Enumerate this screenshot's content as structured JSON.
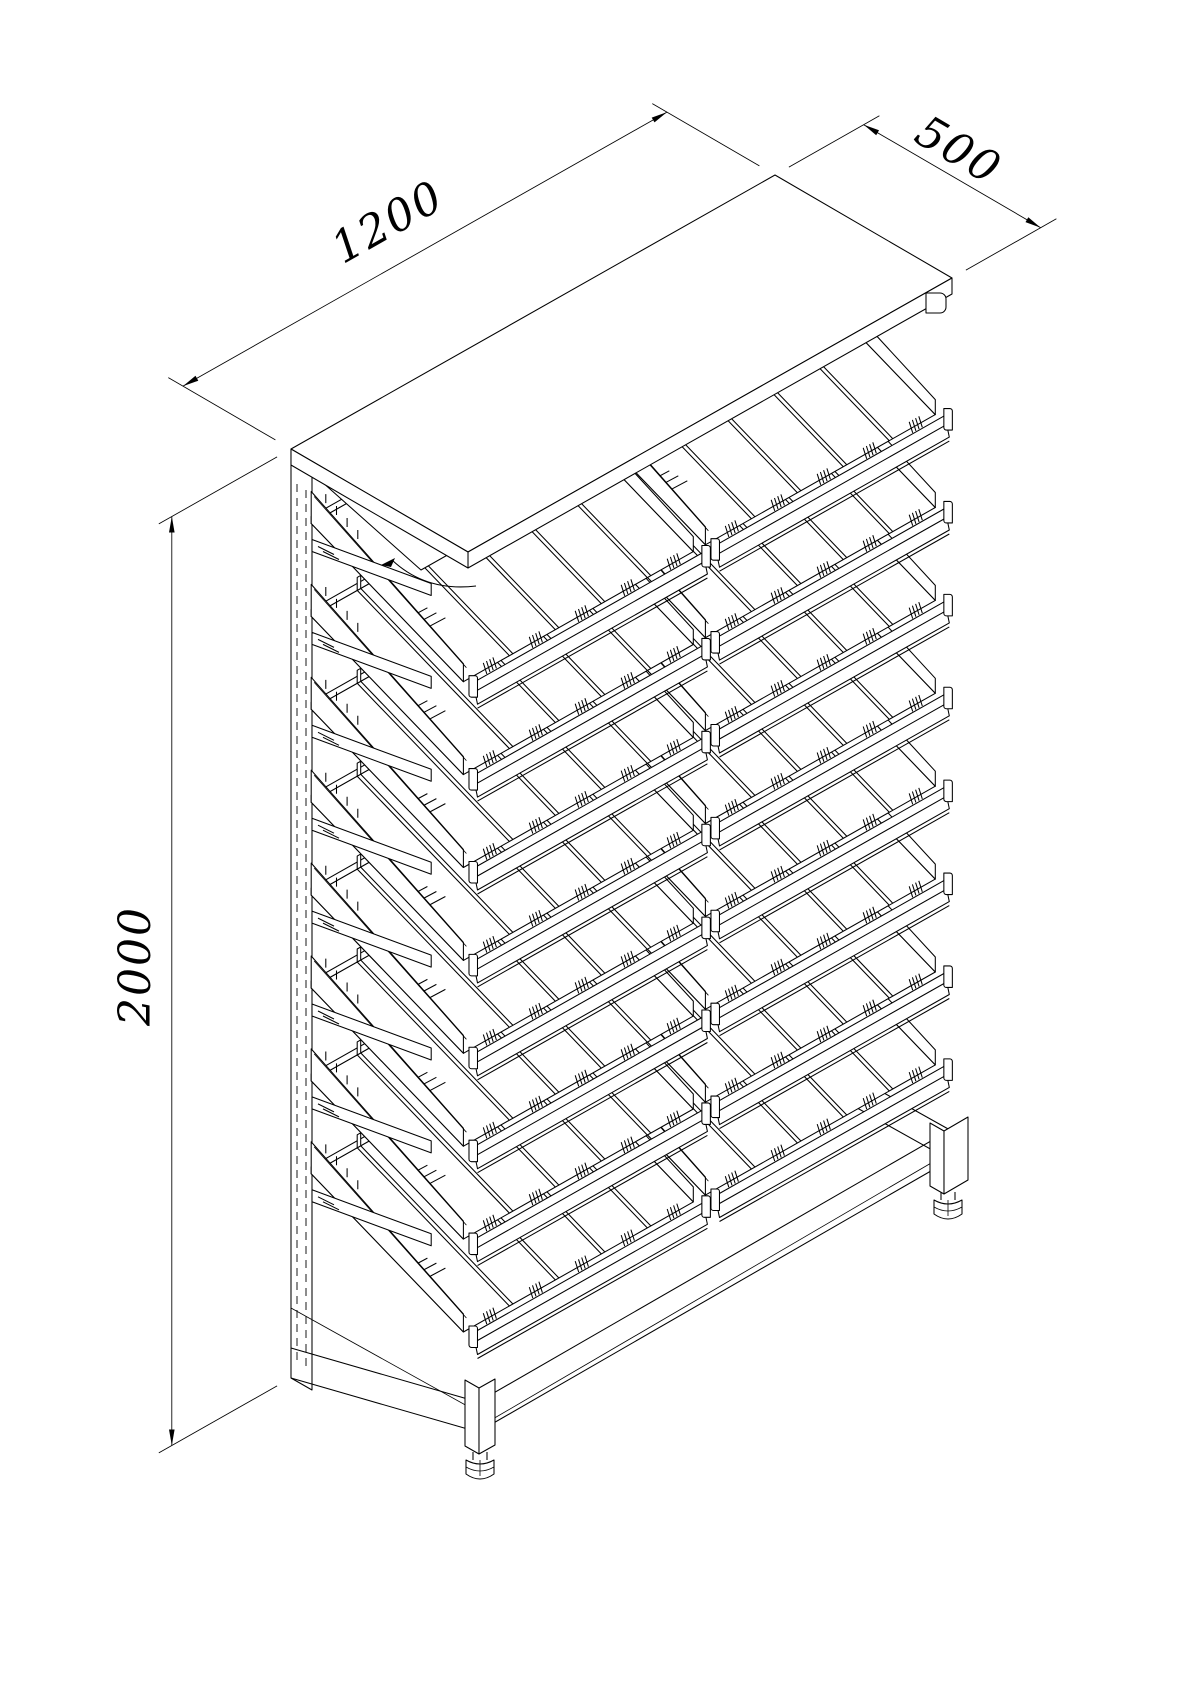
{
  "drawing": {
    "title": "display-rack-isometric-drawing",
    "background_color": "#ffffff",
    "line_color": "#000000",
    "dimensions": {
      "width": {
        "label": "1200"
      },
      "depth": {
        "label": "500"
      },
      "height": {
        "label": "2000"
      }
    },
    "structure": {
      "shelf_rows": 8,
      "bays_per_row": 2,
      "lanes_per_bay": 5,
      "dividers_per_bay": 4,
      "ticks_per_lane": 4,
      "has_canopy": true,
      "back_panel_slotted": true,
      "visible_legs": 2,
      "adjustable_feet": true
    }
  }
}
